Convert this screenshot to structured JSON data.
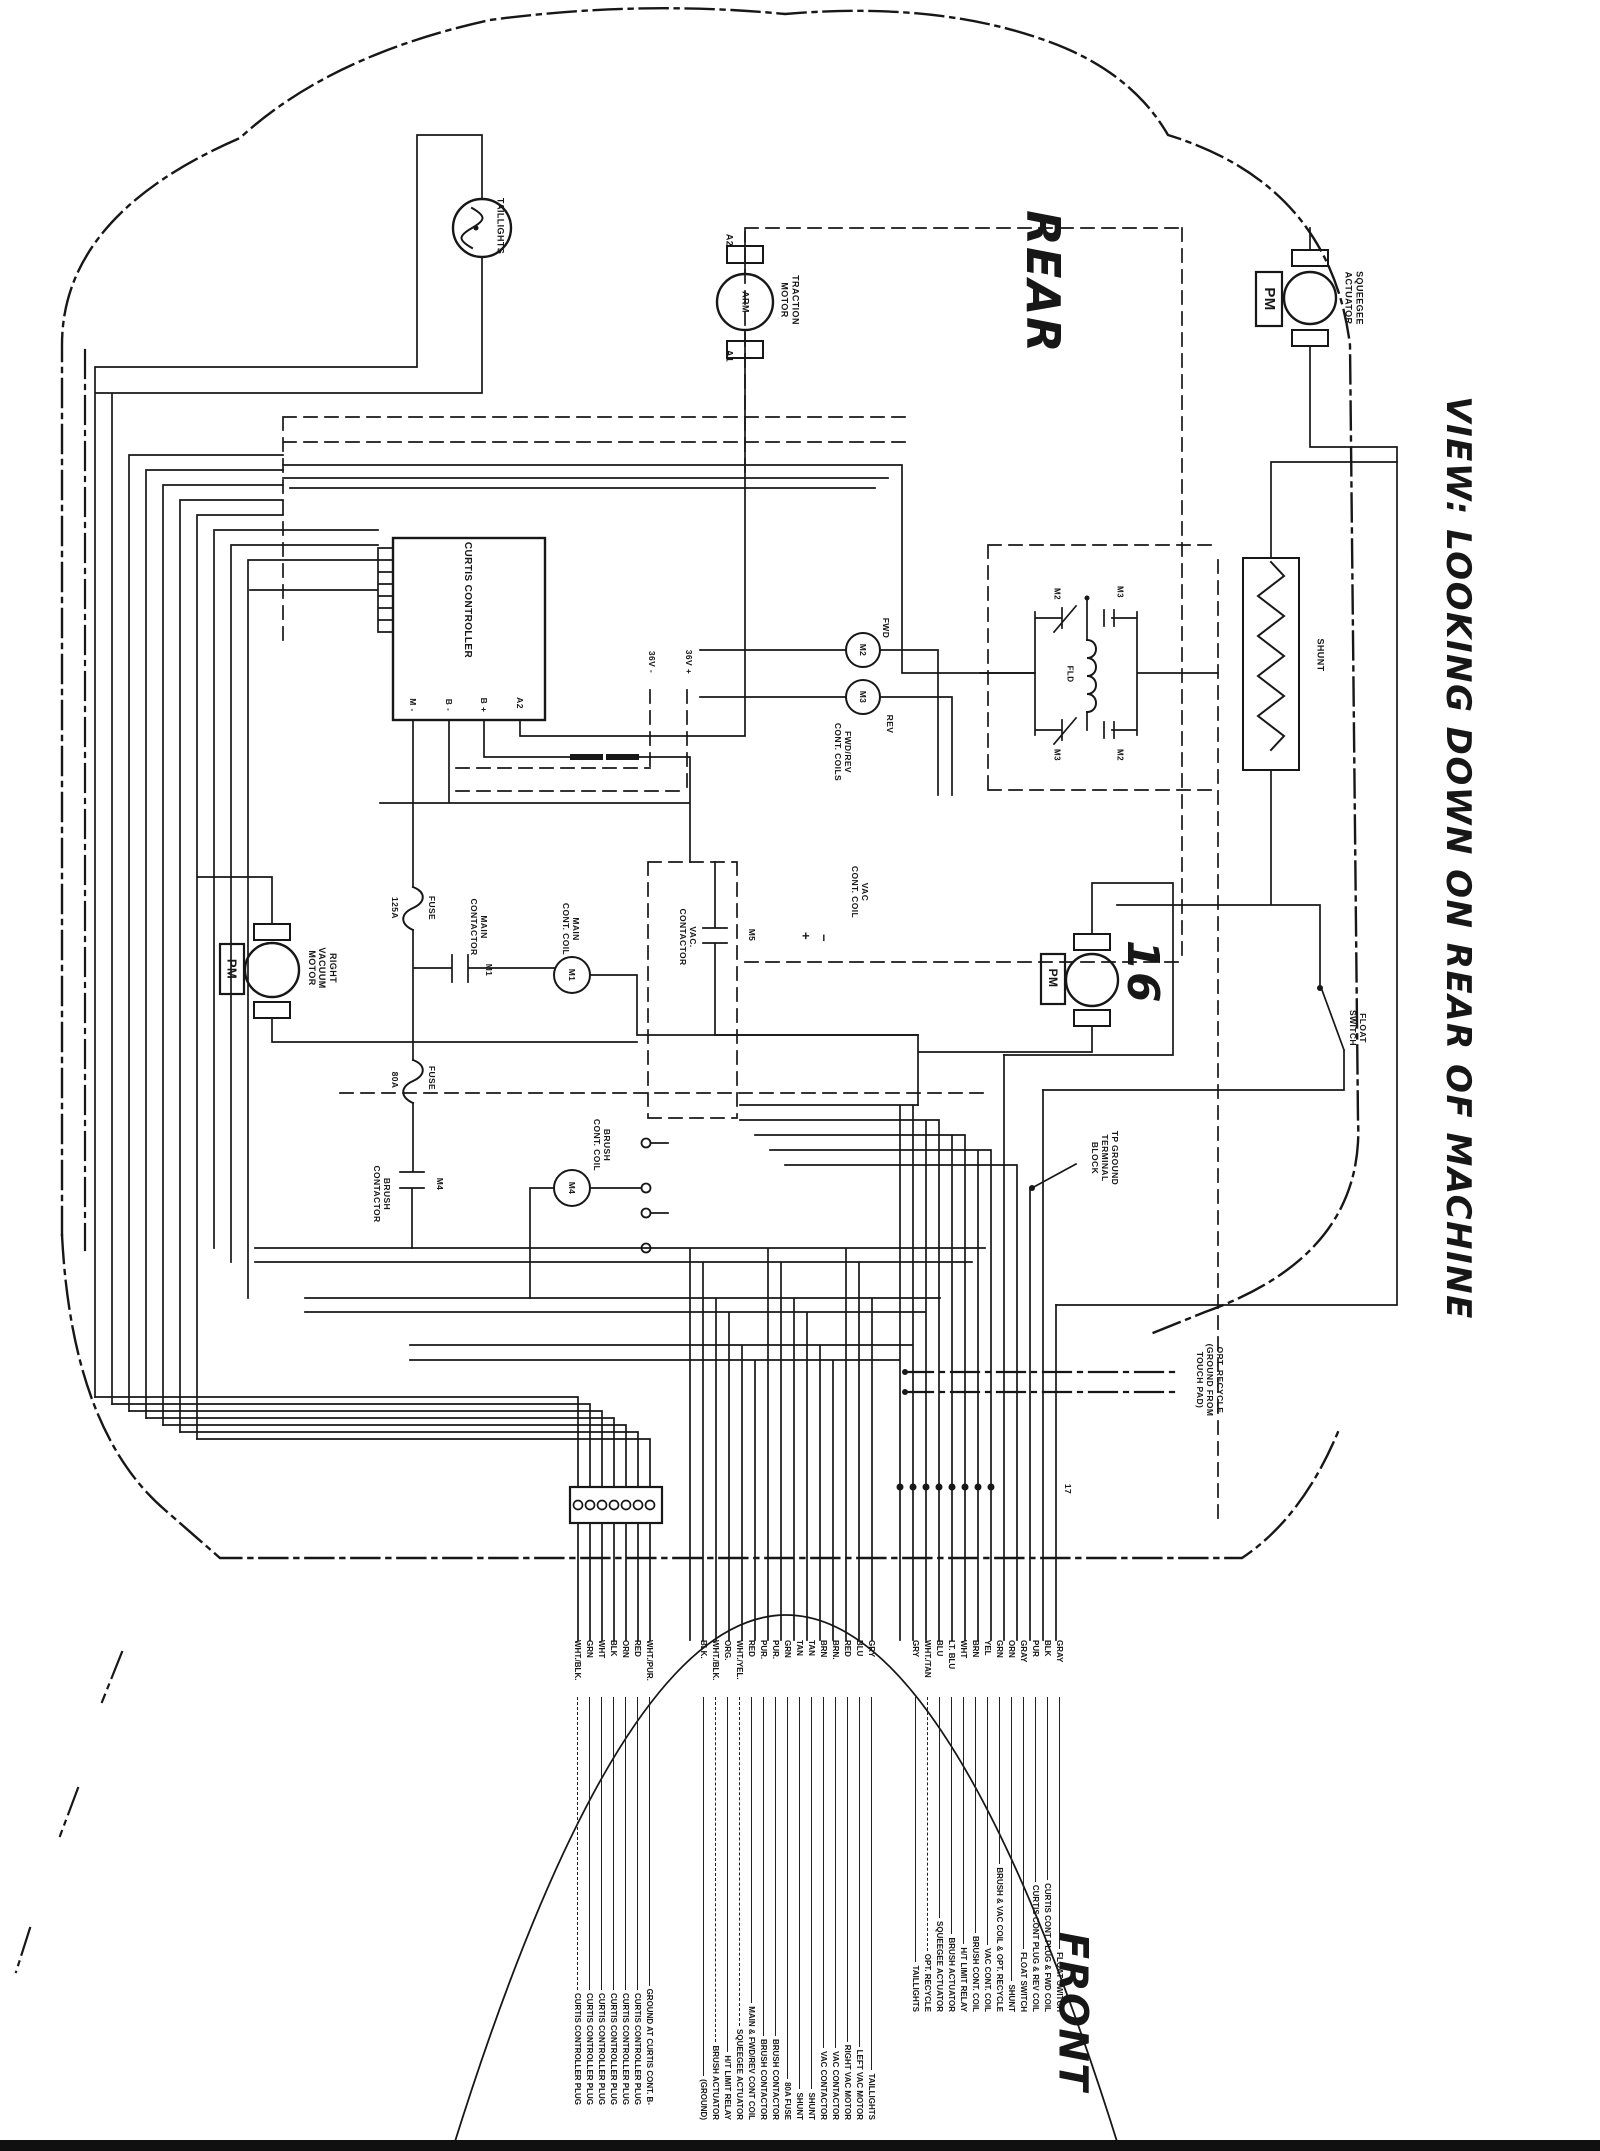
{
  "title": "VIEW: LOOKING DOWN ON REAR OF MACHINE",
  "orientation": {
    "rear": "REAR",
    "front": "FRONT"
  },
  "ink_color": "#171717",
  "paper_color": "#ffffff",
  "labels": [
    {
      "id": "taillights",
      "t": "TAILLIGHTS",
      "x": 500,
      "y": 226,
      "s": 9
    },
    {
      "id": "traction-a2",
      "t": "A2",
      "x": 729,
      "y": 240,
      "s": 9
    },
    {
      "id": "traction-arm",
      "t": "ARM",
      "x": 745,
      "y": 302,
      "s": 9
    },
    {
      "id": "traction-a1",
      "t": "A1",
      "x": 729,
      "y": 356,
      "s": 9
    },
    {
      "id": "traction-motor",
      "t": "TRACTION\nMOTOR",
      "x": 790,
      "y": 300,
      "s": 9
    },
    {
      "id": "rear",
      "t": "REAR",
      "x": 1043,
      "y": 282,
      "s": 46,
      "i": 1
    },
    {
      "id": "squeegee-pm",
      "t": "PM",
      "x": 1269,
      "y": 299,
      "s": 15
    },
    {
      "id": "squeegee-actuator",
      "t": "SQUEEGEE\nACTUATOR",
      "x": 1354,
      "y": 298,
      "s": 9
    },
    {
      "id": "curtis-controller",
      "t": "CURTIS CONTROLLER",
      "x": 467,
      "y": 600,
      "s": 10
    },
    {
      "id": "term-m-minus",
      "t": "M -",
      "x": 413,
      "y": 705,
      "s": 8.5
    },
    {
      "id": "term-b-minus",
      "t": "B -",
      "x": 449,
      "y": 705,
      "s": 8.5
    },
    {
      "id": "term-b-plus",
      "t": "B +",
      "x": 484,
      "y": 705,
      "s": 8.5
    },
    {
      "id": "term-a2",
      "t": "A2",
      "x": 520,
      "y": 703,
      "s": 8.5
    },
    {
      "id": "aux-neg",
      "t": "36V -",
      "x": 652,
      "y": 662,
      "s": 8.5
    },
    {
      "id": "aux-pos",
      "t": "36V +",
      "x": 689,
      "y": 662,
      "s": 8.5
    },
    {
      "id": "fwd",
      "t": "FWD",
      "x": 886,
      "y": 628,
      "s": 8.5
    },
    {
      "id": "m2-coil",
      "t": "M2",
      "x": 863,
      "y": 650,
      "s": 8.5
    },
    {
      "id": "rev",
      "t": "REV",
      "x": 890,
      "y": 724,
      "s": 8.5
    },
    {
      "id": "m3-coil",
      "t": "M3",
      "x": 863,
      "y": 697,
      "s": 8.5
    },
    {
      "id": "fwdrev-coils",
      "t": "FWD/REV\nCONT. COILS",
      "x": 843,
      "y": 752,
      "s": 8.5
    },
    {
      "id": "m2-contact-tl",
      "t": "M2",
      "x": 1057,
      "y": 594,
      "s": 8
    },
    {
      "id": "m3-contact-tr",
      "t": "M3",
      "x": 1120,
      "y": 592,
      "s": 8
    },
    {
      "id": "field-coil",
      "t": "FLD",
      "x": 1070,
      "y": 674,
      "s": 8
    },
    {
      "id": "m3-contact-bl",
      "t": "M3",
      "x": 1057,
      "y": 755,
      "s": 8
    },
    {
      "id": "m2-contact-br",
      "t": "M2",
      "x": 1120,
      "y": 755,
      "s": 8
    },
    {
      "id": "shunt",
      "t": "SHUNT",
      "x": 1320,
      "y": 655,
      "s": 9
    },
    {
      "id": "pm-right-vac",
      "t": "PM",
      "x": 232,
      "y": 969,
      "s": 13
    },
    {
      "id": "right-vacuum-motor",
      "t": "RIGHT\nVACUUM\nMOTOR",
      "x": 322,
      "y": 968,
      "s": 9
    },
    {
      "id": "fuse125-amp",
      "t": "125A",
      "x": 395,
      "y": 908,
      "s": 8.5
    },
    {
      "id": "fuse125",
      "t": "FUSE",
      "x": 432,
      "y": 908,
      "s": 8.5
    },
    {
      "id": "main-contactor",
      "t": "MAIN\nCONTACTOR",
      "x": 479,
      "y": 927,
      "s": 8.5
    },
    {
      "id": "m1-contact",
      "t": "M1",
      "x": 489,
      "y": 970,
      "s": 8.5
    },
    {
      "id": "main-cont-coil",
      "t": "MAIN\nCONT. COIL",
      "x": 571,
      "y": 929,
      "s": 8.5
    },
    {
      "id": "m1-coil",
      "t": "M1",
      "x": 572,
      "y": 975,
      "s": 8.5
    },
    {
      "id": "vac-contactor",
      "t": "VAC.\nCONTACTOR",
      "x": 688,
      "y": 937,
      "s": 8.5
    },
    {
      "id": "m5-contact",
      "t": "M5",
      "x": 752,
      "y": 935,
      "s": 8.5
    },
    {
      "id": "plus-mark",
      "t": "+",
      "x": 806,
      "y": 936,
      "s": 13
    },
    {
      "id": "minus-mark",
      "t": "−",
      "x": 824,
      "y": 938,
      "s": 13
    },
    {
      "id": "vac-cont-coil",
      "t": "VAC\nCONT. COIL",
      "x": 860,
      "y": 892,
      "s": 8.5
    },
    {
      "id": "fuse80-amp",
      "t": "80A",
      "x": 395,
      "y": 1080,
      "s": 8.5
    },
    {
      "id": "fuse80",
      "t": "FUSE",
      "x": 432,
      "y": 1078,
      "s": 8.5
    },
    {
      "id": "brush-contactor",
      "t": "BRUSH\nCONTACTOR",
      "x": 382,
      "y": 1194,
      "s": 8.5
    },
    {
      "id": "m4-contact",
      "t": "M4",
      "x": 440,
      "y": 1184,
      "s": 8.5
    },
    {
      "id": "brush-cont-coil",
      "t": "BRUSH\nCONT. COIL",
      "x": 602,
      "y": 1145,
      "s": 8.5
    },
    {
      "id": "m4-coil",
      "t": "M4",
      "x": 572,
      "y": 1188,
      "s": 8.5
    },
    {
      "id": "pm-left-vac",
      "t": "PM",
      "x": 1053,
      "y": 978,
      "s": 12
    },
    {
      "id": "handwritten-16",
      "t": "16",
      "x": 1142,
      "y": 972,
      "s": 44,
      "i": 1
    },
    {
      "id": "tp-ground-block",
      "t": "TP GROUND\nTERMINAL\nBLOCK",
      "x": 1105,
      "y": 1158,
      "s": 8.5
    },
    {
      "id": "float-switch",
      "t": "FLOAT\nSWITCH",
      "x": 1358,
      "y": 1028,
      "s": 8.5
    },
    {
      "id": "opt-recycle-note",
      "t": "OPT. RECYCLE\n(GROUND FROM\nTOUCH PAD)",
      "x": 1210,
      "y": 1380,
      "s": 8.5
    },
    {
      "id": "pin-17",
      "t": "17",
      "x": 1068,
      "y": 1489,
      "s": 8.5
    },
    {
      "id": "view-note",
      "t": "VIEW: LOOKING DOWN ON REAR OF MACHINE",
      "x": 1458,
      "y": 858,
      "s": 34,
      "i": 1
    },
    {
      "id": "front",
      "t": "FRONT",
      "x": 1072,
      "y": 2012,
      "s": 40,
      "i": 1
    }
  ],
  "wire_lists": {
    "curtis_plug": {
      "x": 656,
      "y": 1640,
      "len": 465,
      "wires": [
        {
          "c": "WHT./PUR.",
          "t": "GROUND AT CURTIS CONT. B-"
        },
        {
          "c": "RED",
          "t": "CURTIS CONTROLLER PLUG"
        },
        {
          "c": "ORN",
          "t": "CURTIS CONTROLLER PLUG"
        },
        {
          "c": "BLK",
          "t": "CURTIS CONTROLLER PLUG"
        },
        {
          "c": "WHT",
          "t": "CURTIS CONTROLLER PLUG"
        },
        {
          "c": "GRN",
          "t": "CURTIS CONTROLLER PLUG"
        },
        {
          "c": "WHT./BLK.",
          "t": "CURTIS CONTROLLER PLUG",
          "d": true
        }
      ]
    },
    "component_bundle": {
      "x": 878,
      "y": 1640,
      "len": 480,
      "wires": [
        {
          "c": "GRY",
          "t": "TAILLIGHTS"
        },
        {
          "c": "BLU",
          "t": "LEFT VAC MOTOR"
        },
        {
          "c": "RED",
          "t": "RIGHT VAC MOTOR"
        },
        {
          "c": "BRN.",
          "t": "VAC CONTACTOR"
        },
        {
          "c": "BRN",
          "t": "VAC CONTACTOR"
        },
        {
          "c": "TAN",
          "t": "SHUNT"
        },
        {
          "c": "TAN",
          "t": "SHUNT"
        },
        {
          "c": "GRN",
          "t": "80A FUSE"
        },
        {
          "c": "PUR.",
          "t": "BRUSH CONTACTOR"
        },
        {
          "c": "PUR.",
          "t": "BRUSH CONTACTOR"
        },
        {
          "c": "RED",
          "t": "MAIN & FWD/REV CONT COIL"
        },
        {
          "c": "WHT./YEL.",
          "t": "SQUEEGEE ACTUATOR",
          "d": true
        },
        {
          "c": "ORG.",
          "t": "H/T LIMIT RELAY"
        },
        {
          "c": "WHT./BLK.",
          "t": "BRUSH ACTUATOR",
          "d": true
        },
        {
          "c": "BLK.",
          "t": "(GROUND)"
        }
      ]
    },
    "accessory_bundle": {
      "x": 1066,
      "y": 1640,
      "len": 372,
      "wires": [
        {
          "c": "GRAY",
          "t": "FLOAT SWITCH"
        },
        {
          "c": "BLK",
          "t": "CURTIS CONT PLUG & FWD COIL"
        },
        {
          "c": "PUR",
          "t": "CURTIS CONT PLUG & REV COIL"
        },
        {
          "c": "GRAY",
          "t": "FLOAT SWITCH"
        },
        {
          "c": "ORN",
          "t": "SHUNT"
        },
        {
          "c": "GRN",
          "t": "BRUSH & VAC COIL & OPT. RECYCLE"
        },
        {
          "c": "YEL",
          "t": "VAC CONT. COIL"
        },
        {
          "c": "BRN",
          "t": "BRUSH CONT. COIL"
        },
        {
          "c": "WHT",
          "t": "H/T LIMIT RELAY"
        },
        {
          "c": "LT. BLU",
          "t": "BRUSH ACTUATOR"
        },
        {
          "c": "BLU",
          "t": "SQUEEGEE ACTUATOR"
        },
        {
          "c": "WHT./TAN",
          "t": "OPT. RECYCLE",
          "d": true
        },
        {
          "c": "GRY",
          "t": "TAILLIGHTS"
        }
      ]
    }
  }
}
